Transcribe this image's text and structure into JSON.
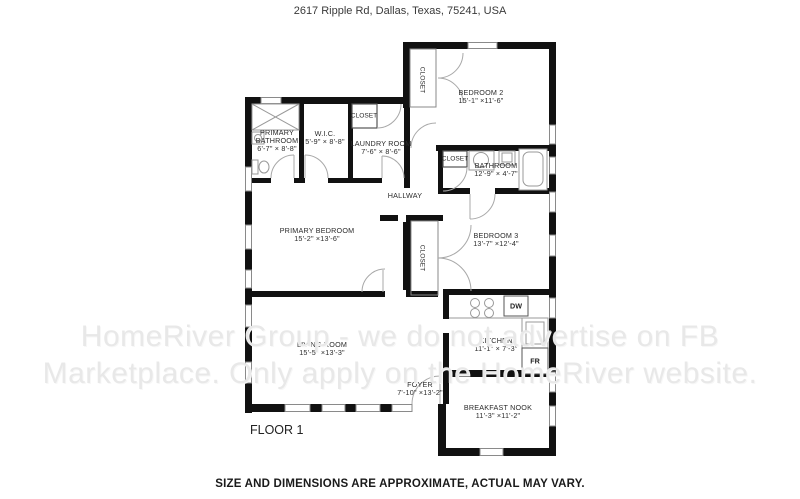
{
  "header": {
    "address": "2617 Ripple Rd, Dallas, Texas, 75241, USA"
  },
  "footer": {
    "disclaimer": "SIZE AND DIMENSIONS ARE APPROXIMATE, ACTUAL MAY VARY."
  },
  "watermark": {
    "line1": "HomeRiver Group - we do not advertise on FB",
    "line2": "Marketplace. Only apply on the HomeRiver website."
  },
  "floor_label": "FLOOR 1",
  "rooms": [
    {
      "id": "primary-bathroom",
      "name": "PRIMARY\nBATHROOM",
      "dims": "6'-7\" × 8'-8\""
    },
    {
      "id": "wic",
      "name": "W.I.C.",
      "dims": "5'-9\" × 8'-8\""
    },
    {
      "id": "laundry-room",
      "name": "LAUNDRY ROOM",
      "dims": "7'-6\" × 8'-6\""
    },
    {
      "id": "bedroom-2",
      "name": "BEDROOM 2",
      "dims": "15'-1\" ×11'-6\""
    },
    {
      "id": "bathroom",
      "name": "BATHROOM",
      "dims": "12'-9\" × 4'-7\""
    },
    {
      "id": "hallway",
      "name": "HALLWAY",
      "dims": ""
    },
    {
      "id": "primary-bedroom",
      "name": "PRIMARY BEDROOM",
      "dims": "15'-2\" ×13'-6\""
    },
    {
      "id": "bedroom-3",
      "name": "BEDROOM 3",
      "dims": "13'-7\" ×12'-4\""
    },
    {
      "id": "living-room",
      "name": "LIVING ROOM",
      "dims": "15'-5\" ×13'-3\""
    },
    {
      "id": "kitchen",
      "name": "KITCHEN",
      "dims": "11'-1\" × 7'-3\""
    },
    {
      "id": "foyer",
      "name": "FOYER",
      "dims": "7'-10\" ×13'-2\""
    },
    {
      "id": "breakfast-nook",
      "name": "BREAKFAST NOOK",
      "dims": "11'-3\" ×11'-2\""
    }
  ],
  "labels": {
    "closet": "CLOSET",
    "dw": "DW",
    "fr": "FR"
  },
  "colors": {
    "wall": "#111111",
    "door_arc": "#a8a8a8",
    "fixture_line": "#999999",
    "window_line": "#8a8a8a",
    "text": "#2b2b2b",
    "watermark": "#e8e8e8"
  }
}
